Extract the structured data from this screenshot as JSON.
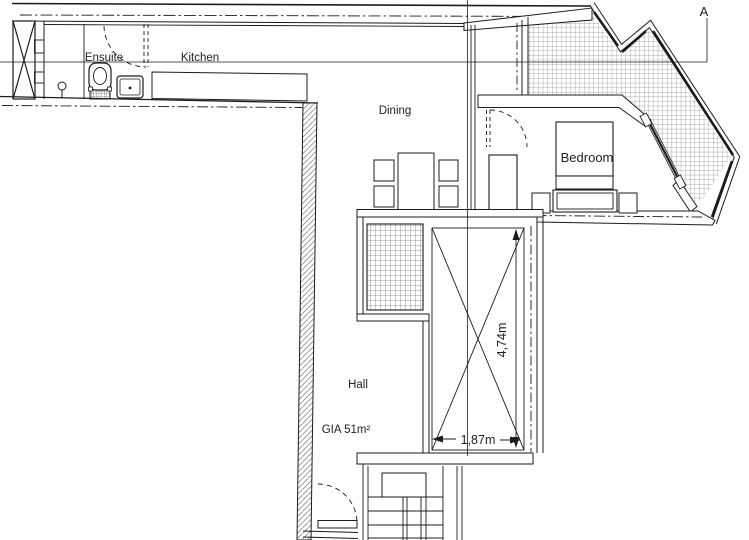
{
  "plan": {
    "labels": {
      "ensuite": "Ensuite",
      "kitchen": "Kitchen",
      "dining": "Dining",
      "bedroom": "Bedroom",
      "hall": "Hall",
      "gia": "GIA 51m²"
    },
    "dimensions": {
      "void_height": "4,74m",
      "void_width": "1,87m"
    },
    "section_marker": "A",
    "colors": {
      "line": "#1c1c1c",
      "terrace_hatch": "#8d8d8d",
      "wall_hatch": "#8a8a8a",
      "background": "#ffffff"
    }
  }
}
